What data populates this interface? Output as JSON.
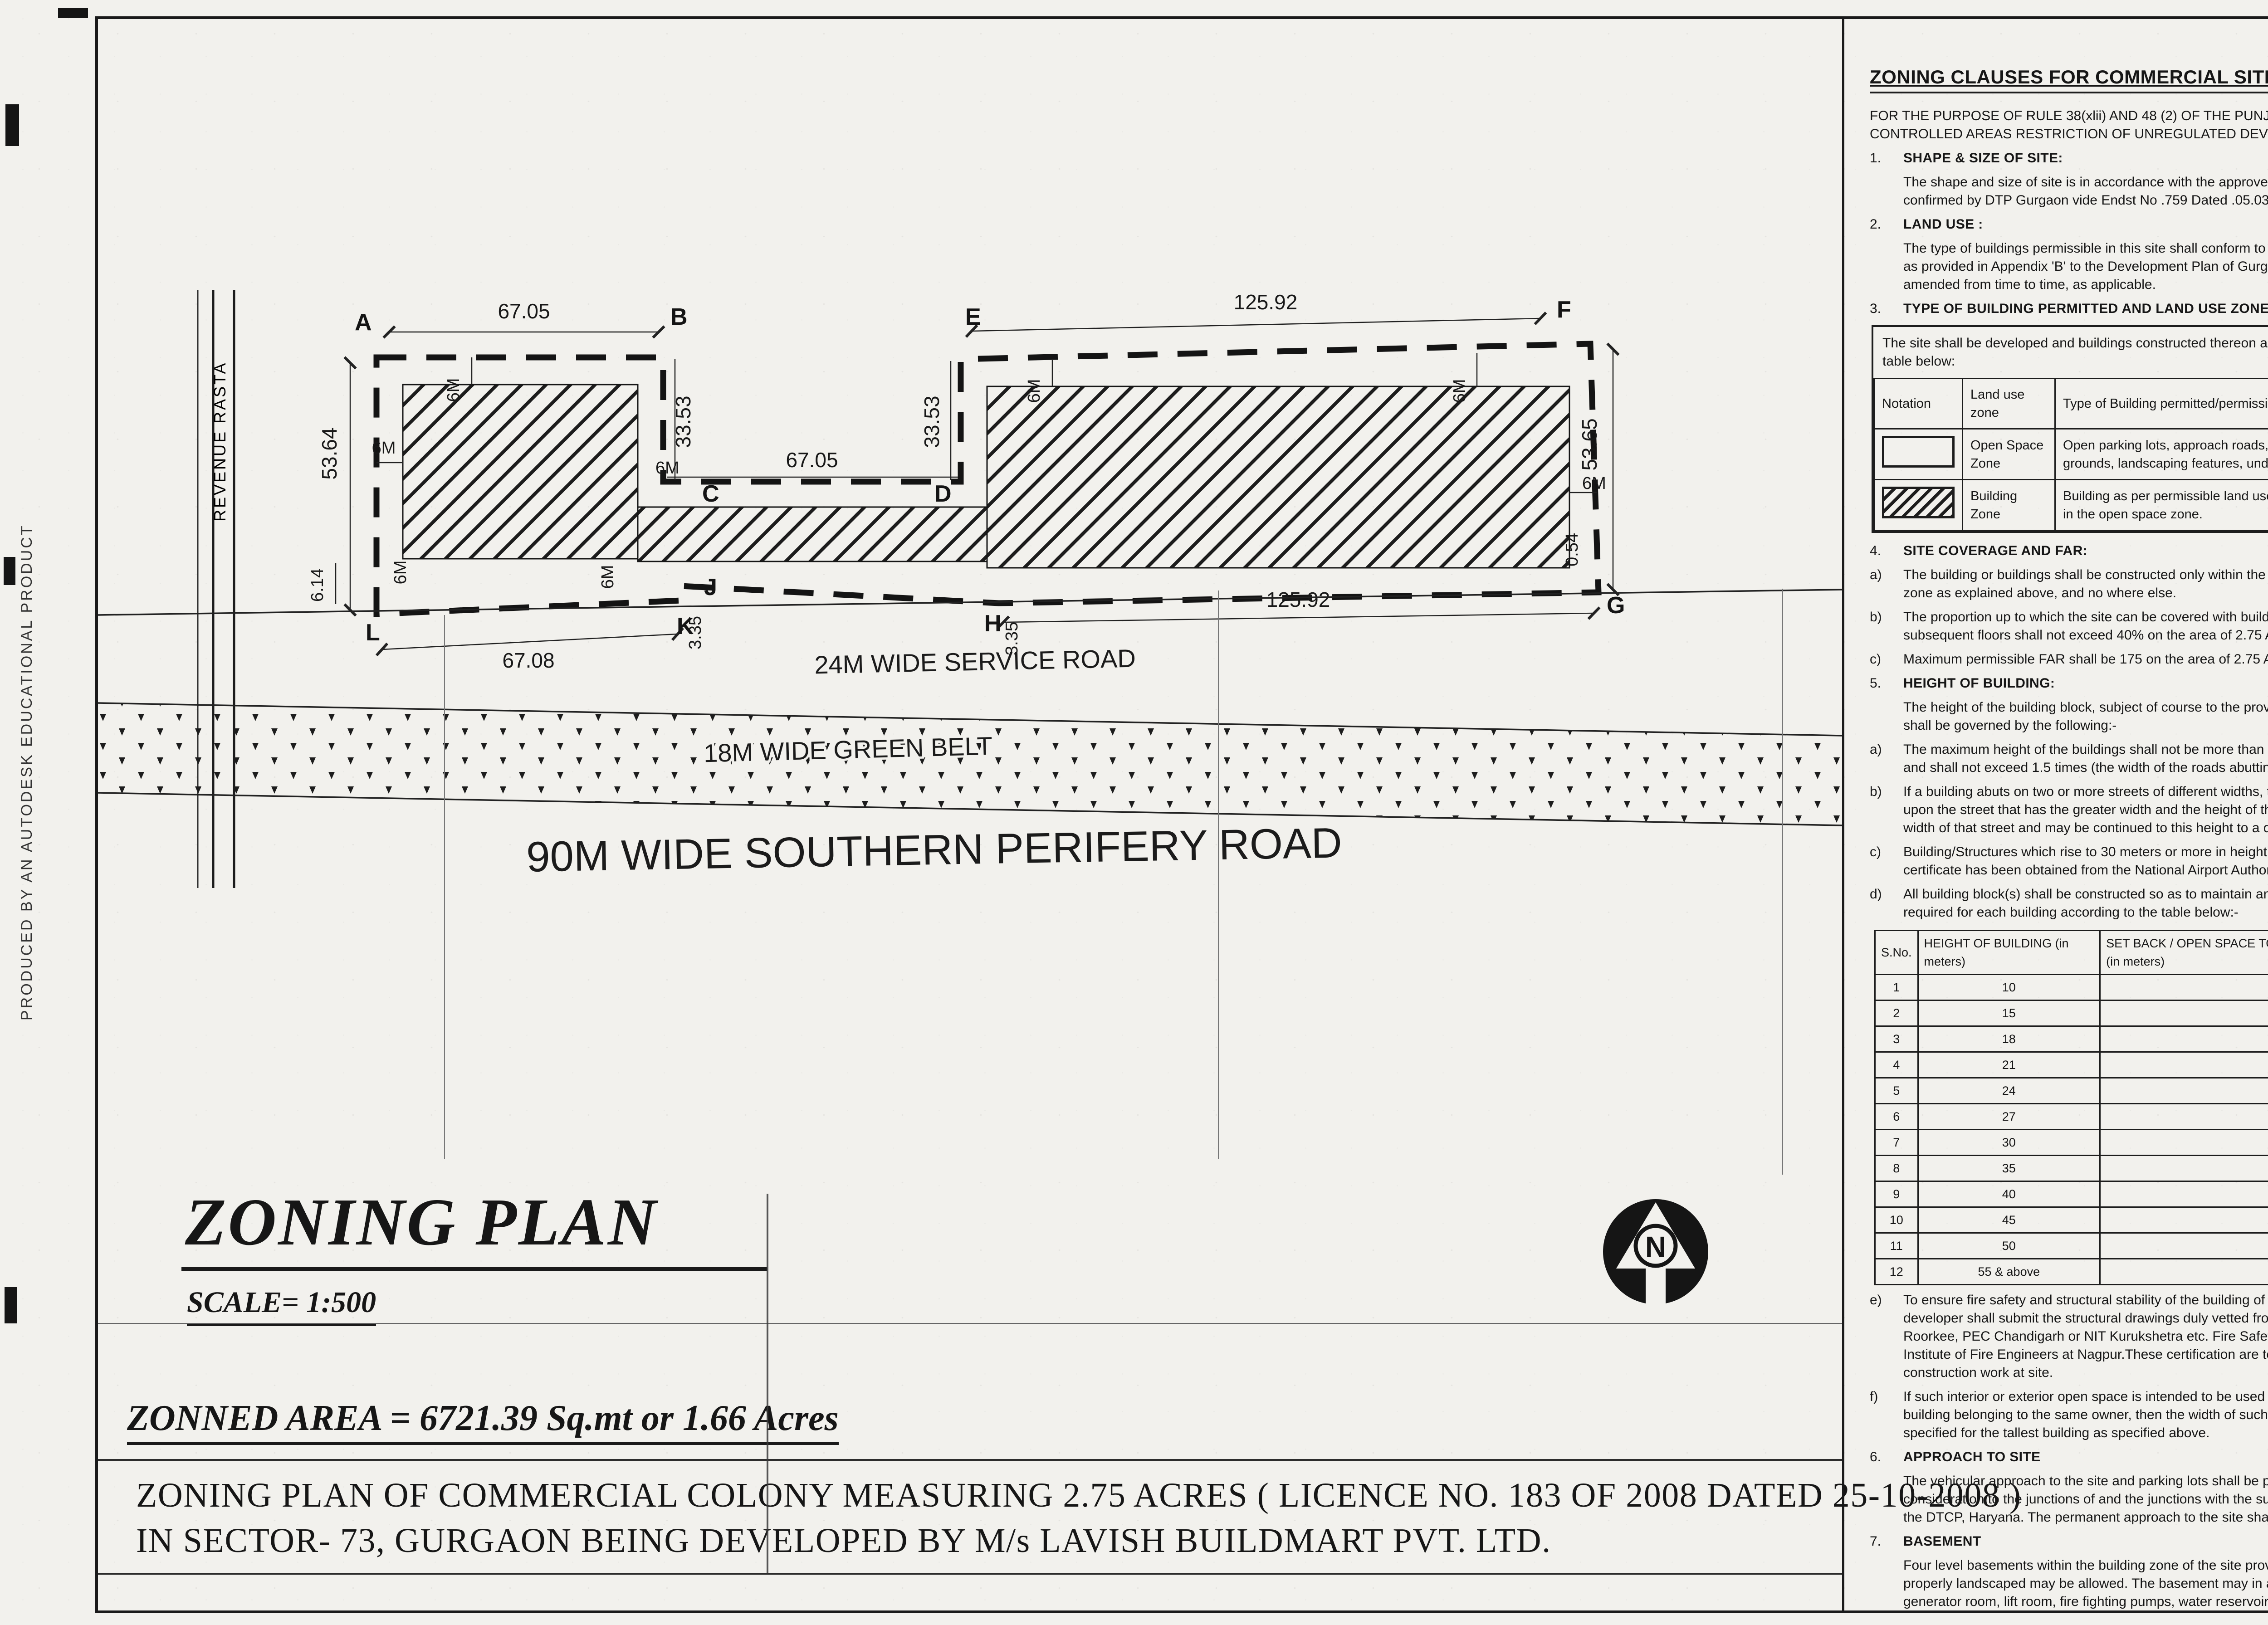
{
  "sheet": {
    "edge_note": "PRODUCED BY AN AUTODESK EDUCATIONAL PRODUCT",
    "colors": {
      "ink": "#1a1a1a",
      "paper": "#f2f1ed"
    }
  },
  "plan": {
    "revenue_rasta": "REVENUE RASTA",
    "north_label": "N",
    "points": {
      "a": "A",
      "b": "B",
      "c": "C",
      "d": "D",
      "e": "E",
      "f": "F",
      "g": "G",
      "h": "H",
      "j": "J",
      "k": "K",
      "l": "L"
    },
    "dims": {
      "ab": "67.05",
      "ef": "125.92",
      "cd": "67.05",
      "lk": "67.08",
      "hg": "125.92",
      "left": "53.64",
      "right": "53.65",
      "bc": "33.53",
      "ed": "33.53",
      "jk": "3.35",
      "h2": "3.35",
      "bl": "6.14",
      "g": "0.54",
      "setback": "6M"
    },
    "roads": {
      "service": "24M WIDE SERVICE ROAD",
      "green_belt": "18M WIDE GREEN BELT",
      "periphery": "90M WIDE SOUTHERN PERIFERY ROAD"
    }
  },
  "titleblock": {
    "title": "ZONING PLAN",
    "scale": "SCALE= 1:500",
    "area": "ZONNED AREA = 6721.39 Sq.mt or 1.66 Acres",
    "caption_line1": "ZONING PLAN OF COMMERCIAL COLONY MEASURING 2.75 ACRES ( LICENCE NO. 183 OF 2008 DATED 25-10-2008 )",
    "caption_line2": "IN SECTOR- 73, GURGAON BEING DEVELOPED BY M/s LAVISH BUILDMART PVT. LTD."
  },
  "middle": {
    "heading": "ZONING CLAUSES FOR COMMERCIAL SITE",
    "intro": "FOR THE PURPOSE OF RULE 38(xlii) AND 48 (2) OF THE PUNJAB SCHEDULED ROADS AND CONTROLLED AREAS RESTRICTION OF UNREGULATED DEVELOPMENT RULES, 1965.",
    "blocks_a": [
      {
        "pre": "1.",
        "title": "SHAPE & SIZE OF SITE:",
        "text": ""
      },
      {
        "pre": "",
        "title": "",
        "text": "The shape and size of site is in accordance with the approved demarcation plan shown as A to L. as confirmed by DTP Gurgaon vide Endst No .759  Dated .05.03.2009"
      },
      {
        "pre": "2.",
        "title": "LAND USE :",
        "text": ""
      },
      {
        "pre": "",
        "title": "",
        "text": "The type of buildings permissible in this site shall conform to the provisions of the residential zone as provided in Appendix 'B' to the Development Plan of Gurgaon Manesar urban complex as amended from time to time, as applicable."
      },
      {
        "pre": "3.",
        "title": "TYPE OF BUILDING PERMITTED AND LAND USE  ZONES:",
        "text": ""
      }
    ],
    "zone_table": {
      "intro": "The site shall be developed and buildings constructed thereon as indicated in and explained in the table below:",
      "headers": [
        "Notation",
        "Land use zone",
        "Type of Building permitted/permissible structures."
      ],
      "rows": [
        {
          "zone": "Open Space Zone",
          "desc": "Open parking lots, approach roads, roadside furniture, parks and play grounds, landscaping features, under ground services etc."
        },
        {
          "zone": "Building Zone",
          "desc": "Building as per permissible land use in clause above and uses permissible in the open space zone."
        }
      ]
    },
    "blocks_b": [
      {
        "pre": "4.",
        "title": "SITE COVERAGE AND FAR:",
        "text": ""
      },
      {
        "pre": "a)",
        "title": "",
        "text": "The building or buildings shall be constructed only within the portion of the site marked as Building zone as explained above, and no where else."
      },
      {
        "pre": "b)",
        "title": "",
        "text": "The proportion up to which the site can be covered with building or buildings on the ground floor and subsequent floors shall not exceed 40% on the area of 2.75 Acres"
      },
      {
        "pre": "c)",
        "title": "",
        "text": "Maximum permissible FAR shall be 175 on the area of 2.75 Acres."
      },
      {
        "pre": "5.",
        "title": "HEIGHT OF BUILDING:",
        "text": ""
      },
      {
        "pre": "",
        "title": "",
        "text": "The height of the building block, subject of course to the provisions of the site coverage and FAR, shall be governed by the following:-"
      },
      {
        "pre": "a)",
        "title": "",
        "text": "The maximum height of the buildings shall not be more than as allowed by National Airport Authority and shall not exceed 1.5 times (the width of the roads abutting to the site) plus the front open space."
      },
      {
        "pre": "b)",
        "title": "",
        "text": "If a building abuts on two or more streets of different widths, the buildings shall be deemed to face upon the street that has the greater width and the height of the buildings shall be regulated by the width of that street and may be continued to this height to a depth of 24M, along the narrow street."
      },
      {
        "pre": "c)",
        "title": "",
        "text": "Building/Structures which rise to 30 meters or more in height shall be constructed if no objection certificate has been obtained from the National Airport Authority."
      },
      {
        "pre": "d)",
        "title": "",
        "text": "All building block(s) shall be constructed so as to maintain an interse distance not less the set back required for each building according to the table below:-"
      }
    ],
    "setback_table": {
      "headers": [
        "S.No.",
        "HEIGHT OF BUILDING (in meters)",
        "SET BACK / OPEN SPACE TO BE LEFT AROUND BUILDINGS. (in meters)"
      ],
      "rows": [
        [
          "1",
          "10",
          "3"
        ],
        [
          "2",
          "15",
          "5"
        ],
        [
          "3",
          "18",
          "6"
        ],
        [
          "4",
          "21",
          "7"
        ],
        [
          "5",
          "24",
          "8"
        ],
        [
          "6",
          "27",
          "9"
        ],
        [
          "7",
          "30",
          "10"
        ],
        [
          "8",
          "35",
          "11"
        ],
        [
          "9",
          "40",
          "12"
        ],
        [
          "10",
          "45",
          "13"
        ],
        [
          "11",
          "50",
          "14"
        ],
        [
          "12",
          "55 & above",
          "16"
        ]
      ]
    },
    "blocks_c": [
      {
        "pre": "e)",
        "title": "",
        "text": "To ensure fire safety and structural stability of the building of more than 60 meters in height,  the developer shall submit the structural drawings duly vetted from reputed institute like-  IIT Delhi, IIT Roorkee, PEC Chandigarh or NIT Kurukshetra etc. Fire Safety plans needs to be  vetted by the Institute of Fire Engineers at Nagpur.These certification are to be obtained prior  to starting the construction work at site."
      },
      {
        "pre": "f)",
        "title": "",
        "text": "If such interior or exterior open space is intended to be used for the benefit of more  than one building belonging to the same owner, then the width of such open air space  shall be the  one specified for the tallest building as specified above."
      },
      {
        "pre": "6.",
        "title": "APPROACH TO SITE",
        "text": ""
      },
      {
        "pre": "",
        "title": "",
        "text": "The vehicular approach to the site and parking lots shall be planned and provided giving due  consideration to the junctions of and the junctions with the surrounding roads to the satisfaction of the DTCP, Haryana.  The permanent approach to the site shall be derive from the service road."
      },
      {
        "pre": "7.",
        "title": "BASEMENT",
        "text": ""
      },
      {
        "pre": "",
        "title": "",
        "text": "Four level basements within the building zone of the site provided it flushes with the  ground and is properly landscaped may be allowed.  The basement may in addition to  parking could be utilized for generator room, lift room, fire fighting pumps, water  reservoir, electric sub-station, air conditioning plants and toilets/ utilities, if they satisfy the  public health requirements and for no other purposes. Area under stilts (only for parking) and basement  shall not be counted towards FAR.   Basement shall not be used for  storage/commercial purposes but will be used only for parking and ancillary services of the main building and  it is further stipulated that no other partitions of basement will be permissible for uses other than those specified above."
      }
    ]
  },
  "right": {
    "blocks": [
      {
        "pre": "9.",
        "title": "PARKING.",
        "text": ""
      },
      {
        "pre": "a.",
        "title": "",
        "text": "Adequate parking spaces, covered, open or in the basement shall be provided for vehicles of users  and occupiers, within the site."
      },
      {
        "pre": "b.",
        "title": "",
        "text": "Atleast 15% of the parking shall be at the street level."
      },
      {
        "pre": "c.",
        "title": "",
        "text": "The parking spaces for commercial building shall not be less than 1ECS for 50 sqm. of covered area on all floors. The area for parking per car shall be as under:"
      },
      {
        "pre": "(i)",
        "title": "",
        "text": "Basement   =   35 sq. mtrs."
      },
      {
        "pre": "(ii)",
        "title": "",
        "text": "Stilts         =   30 sq. mtrs."
      },
      {
        "pre": "(iii)",
        "title": "",
        "text": "Open       =   25 sq. mtrs."
      },
      {
        "pre": "d.",
        "title": "",
        "text": "The covered parking in the basement or in the form of multi level parking above ground level shall not be counted towards FAR. However, in case of multi level parking above the ground level the foot print of separate parking building block shall be counted towards ground coverage. In case of provision of mechanical parking in the basement floor/ upperstories, the floor to ceiling height of the basement / upper floor  may be maximum of 4.5 mtr. Other than the mechanical parking the floor to ceiling height in upper floor shall not be more than 2.4 mtr. below the hanging beam."
      },
      {
        "pre": "e.",
        "title": "",
        "text": "Not more than 25% of the parking space with in the shopping/commercial complex shall be allotted and this allotment shall be made only to the persons to whom shop/commercial space have been allotted. No parking space shall be allotted, leased out, sold or transferred in any manner to any  third party."
      },
      {
        "pre": "9.",
        "title": "WIDTH/ SLOPE OF RAMP.",
        "text": ""
      },
      {
        "pre": "",
        "title": "",
        "text": "The clear width of the ramp leading to the basement floor shall be minimum 4 mtrs. with an adequate slope not steeper than 1:10. The entry and exit shall be separete preferably at opposite ends."
      },
      {
        "pre": "10.",
        "title": "PLANNING NORMS",
        "text": ""
      },
      {
        "pre": "",
        "title": "",
        "text": "The building/buildings to be constructed shall be planned and designed to the norms and standards as approved by DTCP, Haryana."
      },
      {
        "pre": "11.",
        "title": "PROVISIONS OF PUBLIC HEALTH FACILITIES.",
        "text": ""
      },
      {
        "pre": "",
        "title": "",
        "text": "The W.C. and urinals provided in the buildings shall conform to the National Building Code/Act No. 41  of 1963 and rules framed there under."
      },
      {
        "pre": "12.",
        "title": "SUB DIVISIONS OF SITE",
        "text": ""
      },
      {
        "pre": "",
        "title": "",
        "text": "No sub division of the Commercial Colony shall be permitted."
      },
      {
        "pre": "13.",
        "title": "WIDTH OF COVERED PUBLIC CORRIDOR",
        "text": ""
      },
      {
        "pre": "",
        "title": "",
        "text": "A covered public corridor should have a minimum clear width of 8'- 3\".  However, in case of offices on subsequent floor, the width of the corridor would be governed by Rule 82 of the Rules, 1965."
      },
      {
        "pre": "14.",
        "title": "EXTERNAL FINISHES",
        "text": ""
      },
      {
        "pre": "a)",
        "title": "",
        "text": "The external wall finishes, so far as possible shall be in natural or permanent type of materials like  bricks, stone, concrete, terracotta, grits, marble,  chips, glass, metals or any other finish which may  be allowed by the DTCP."
      },
      {
        "pre": "b)",
        "title": "",
        "text": "The water storage tanks and plumbing works shall not be visible on any face of the building and  shall be suitable encased."
      },
      {
        "pre": "c)",
        "title": "",
        "text": "All sign boards and names shall be written on the spaces provided on buildings as per approved buildings plans specifically for this purpose and at no other places, whatsoever."
      },
      {
        "pre": "15.",
        "title": "APPROVAL OF BUILDING PLANS",
        "text": ""
      },
      {
        "pre": "",
        "title": "",
        "text": "The building plans of the buildings to be constructed at site shall have to be got approved from the DTCP,  Haryana (under section 8(2) of the Act No.41 of 1963), before taking up the construction."
      },
      {
        "pre": "16.",
        "title": "BUILDING BYE - LAWS:",
        "text": ""
      },
      {
        "pre": "",
        "title": "",
        "text": "The construction of the building/buildings shall be governed by the building rules provided in part  Controlled Areas, Restriction of Unregulated Development  VII of the Punjab Scheduled Roads and  1987 regarding provisions for Physically Handicapped Persons.On  Rules, 1965 and IS Code No. 4963- the points where such rules are silent and stipulate no condition or norm, the model building byelaw issued by the ISI, and as given in the NBC shall be followed as may be approved by DTCP, Haryana."
      },
      {
        "pre": "17.",
        "title": "FIRE SAFETY MEASURES:",
        "text": ""
      },
      {
        "pre": "a)",
        "title": "",
        "text": "The owner will ensure the provision of proper fire safety measures in the multi storeyed buildings conforming to the provisions of  Rules 1965/ NBC and the same should be got certified from the  competent authority."
      },
      {
        "pre": "b)",
        "title": "",
        "text": "Electric Sub Station / generator room if provided should be on solid ground near DG/LT. Control  periphery of the  panel on ground floor or in upper basement and it should be located on outer building, the same should be got approved from the Chief Electrical inspector Haryana."
      },
      {
        "pre": "18.",
        "title": "SOLAR WATER HEATING SYSTEM",
        "text": ""
      },
      {
        "pre": "",
        "title": "",
        "text": "The provision of solar water heating system shall be as per norms specified by HAREDA  and shall be made operational in each building block (if hot water is required) before applying for an occupation certificate."
      },
      {
        "pre": "19.",
        "title": "RAIN WATER HARVESTING SYSTEM",
        "text": ""
      },
      {
        "pre": "",
        "title": "",
        "text": "The rain water harvesting system shall be provided as per Central Ground Water Authority norms/Haryana Govt. notification as applicable."
      },
      {
        "pre": "20",
        "title": "",
        "text": "The coloniser shall obtain the clearance/NOC as per the provisions of the Notification  No. S.O. 1533 (E) Dated 14.9.2006 issued by Ministry of Environment and Forest,  Government of India before starting the construction/ execution of development  works at site."
      },
      {
        "pre": "21.",
        "title": "",
        "text": "The coloniser/owner shall use only Compact Fluorescent Lamps fittings for internal lighting as  well as campus lighting."
      },
      {
        "pre": "22.",
        "title": "",
        "text": "The coloniser shall convey the ultimate power load requirement of the project to the concerned power utility to enable the provision of project to the concerned site for transformer/switchingstation /electric  sub station as per the norms prescribed by the power utility in the project site before submission of Building plan not later then 2 months from the approval of zoning plan."
      }
    ],
    "drg": {
      "prefix": "DRG. NO. D.T.C.P.",
      "number": "1850",
      "dated_label": "DATED",
      "date": "8/4/09"
    },
    "signatures": [
      {
        "name": "(F.P.SINGH)",
        "role": "DTP(HQ)"
      },
      {
        "name": "(DHARE SINGH)",
        "role": "CTP(HR)"
      },
      {
        "name": "(S.S. DHILLON)",
        "role": "D.T.C.P (HR)"
      }
    ]
  }
}
